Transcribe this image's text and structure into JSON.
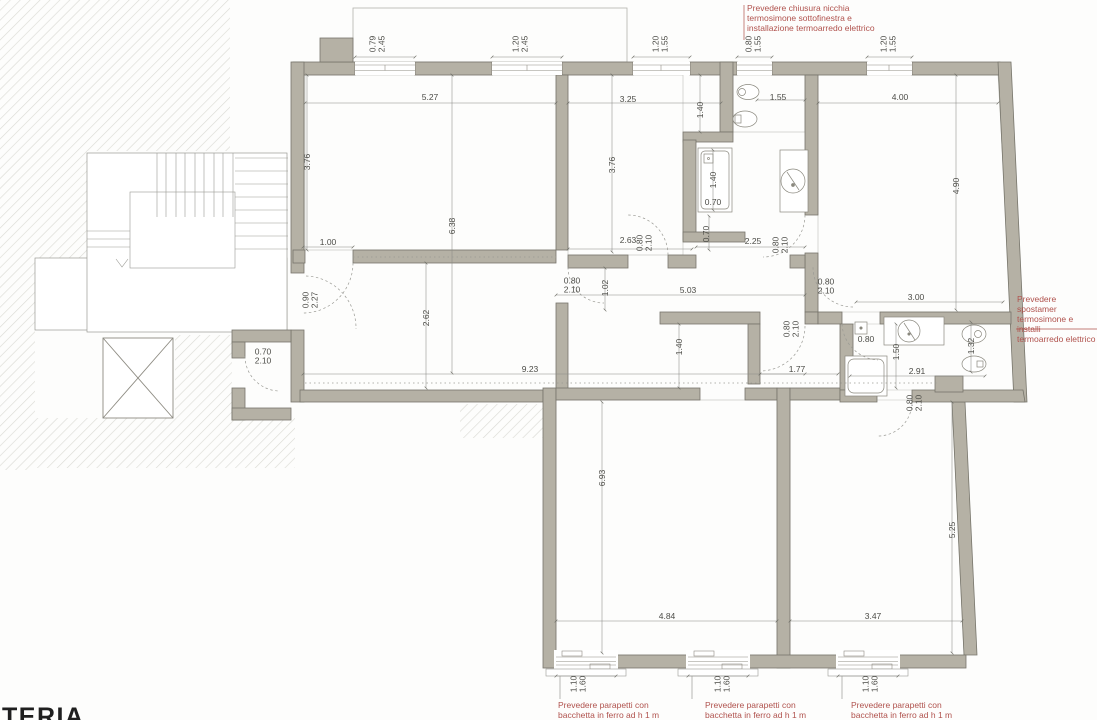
{
  "drawing": {
    "type": "architectural-floor-plan",
    "units": "m"
  },
  "watermark": "TERIA",
  "colors": {
    "wall_fill": "#b5b1a5",
    "wall_stroke": "#77756b",
    "annotation_red": "#b0524d",
    "dimension_text": "#4c4c47",
    "hatch_line": "#dbdbd5",
    "thin_line": "#9a9a94"
  },
  "notes": [
    {
      "id": "niche-note",
      "x": 747,
      "y": 3,
      "lines": [
        "Prevedere chiusura nicchia",
        "termosimone sottofinestra e",
        "installazione termoarredo elettrico"
      ]
    },
    {
      "id": "radiator-move-note",
      "x": 1017,
      "y": 294,
      "lines": [
        "Prevedere spostamer",
        "termosimone e installi",
        "termoarredo elettrico"
      ]
    },
    {
      "id": "parapet-note-1",
      "x": 558,
      "y": 700,
      "lines": [
        "Prevedere parapetti con",
        "bacchetta in ferro ad h 1 m"
      ]
    },
    {
      "id": "parapet-note-2",
      "x": 705,
      "y": 700,
      "lines": [
        "Prevedere parapetti con",
        "bacchetta in ferro ad h 1 m"
      ]
    },
    {
      "id": "parapet-note-3",
      "x": 851,
      "y": 700,
      "lines": [
        "Prevedere parapetti con",
        "bacchetta in ferro ad h 1 m"
      ]
    }
  ],
  "dimensions": [
    {
      "text": "0.79\n2.45",
      "x": 377,
      "y": 44,
      "rot": -90
    },
    {
      "text": "1.20\n2.45",
      "x": 520,
      "y": 44,
      "rot": -90
    },
    {
      "text": "1.20\n1.55",
      "x": 660,
      "y": 44,
      "rot": -90
    },
    {
      "text": "0.80\n1.55",
      "x": 753,
      "y": 44,
      "rot": -90
    },
    {
      "text": "1.20\n1.55",
      "x": 888,
      "y": 44,
      "rot": -90
    },
    {
      "text": "5.27",
      "x": 430,
      "y": 97,
      "rot": 0
    },
    {
      "text": "3.25",
      "x": 628,
      "y": 99,
      "rot": 0
    },
    {
      "text": "1.55",
      "x": 778,
      "y": 97,
      "rot": 0
    },
    {
      "text": "4.00",
      "x": 900,
      "y": 97,
      "rot": 0
    },
    {
      "text": "3.76",
      "x": 307,
      "y": 162,
      "rot": -90
    },
    {
      "text": "3.76",
      "x": 612,
      "y": 165,
      "rot": -90
    },
    {
      "text": "6.38",
      "x": 452,
      "y": 226,
      "rot": -90
    },
    {
      "text": "4.90",
      "x": 956,
      "y": 186,
      "rot": -90
    },
    {
      "text": "1.40",
      "x": 700,
      "y": 110,
      "rot": -90
    },
    {
      "text": "1.40",
      "x": 713,
      "y": 180,
      "rot": -90
    },
    {
      "text": "0.70",
      "x": 713,
      "y": 202,
      "rot": 0
    },
    {
      "text": "0.70",
      "x": 706,
      "y": 234,
      "rot": -90
    },
    {
      "text": "1.00",
      "x": 328,
      "y": 242,
      "rot": 0
    },
    {
      "text": "2.63",
      "x": 628,
      "y": 240,
      "rot": 0
    },
    {
      "text": "0.80\n2.10",
      "x": 644,
      "y": 243,
      "rot": -90
    },
    {
      "text": "2.25",
      "x": 753,
      "y": 241,
      "rot": 0
    },
    {
      "text": "0.80\n2.10",
      "x": 780,
      "y": 245,
      "rot": -90
    },
    {
      "text": "0.90\n2.27",
      "x": 310,
      "y": 300,
      "rot": -90
    },
    {
      "text": "0.80\n2.10",
      "x": 572,
      "y": 285,
      "rot": 0
    },
    {
      "text": "1.02",
      "x": 605,
      "y": 288,
      "rot": -90
    },
    {
      "text": "5.03",
      "x": 688,
      "y": 290,
      "rot": 0
    },
    {
      "text": "0.80\n2.10",
      "x": 826,
      "y": 286,
      "rot": 0
    },
    {
      "text": "3.00",
      "x": 916,
      "y": 297,
      "rot": 0
    },
    {
      "text": "0.70\n2.10",
      "x": 263,
      "y": 356,
      "rot": 0
    },
    {
      "text": "2.62",
      "x": 426,
      "y": 318,
      "rot": -90
    },
    {
      "text": "0.80\n2.10",
      "x": 791,
      "y": 329,
      "rot": -90
    },
    {
      "text": "0.80",
      "x": 866,
      "y": 339,
      "rot": 0
    },
    {
      "text": "1.50",
      "x": 896,
      "y": 352,
      "rot": -90
    },
    {
      "text": "1.32",
      "x": 971,
      "y": 346,
      "rot": -90
    },
    {
      "text": "9.23",
      "x": 530,
      "y": 369,
      "rot": 0
    },
    {
      "text": "1.40",
      "x": 679,
      "y": 347,
      "rot": -90
    },
    {
      "text": "1.77",
      "x": 797,
      "y": 369,
      "rot": 0
    },
    {
      "text": "2.91",
      "x": 917,
      "y": 371,
      "rot": 0
    },
    {
      "text": "0.80\n2.10",
      "x": 914,
      "y": 403,
      "rot": -90
    },
    {
      "text": "6.93",
      "x": 602,
      "y": 478,
      "rot": -90
    },
    {
      "text": "5.25",
      "x": 952,
      "y": 530,
      "rot": -90
    },
    {
      "text": "4.84",
      "x": 667,
      "y": 616,
      "rot": 0
    },
    {
      "text": "3.47",
      "x": 873,
      "y": 616,
      "rot": 0
    },
    {
      "text": "1.10\n1.60",
      "x": 578,
      "y": 684,
      "rot": -90
    },
    {
      "text": "1.10\n1.60",
      "x": 722,
      "y": 684,
      "rot": -90
    },
    {
      "text": "1.10\n1.60",
      "x": 870,
      "y": 684,
      "rot": -90
    }
  ]
}
